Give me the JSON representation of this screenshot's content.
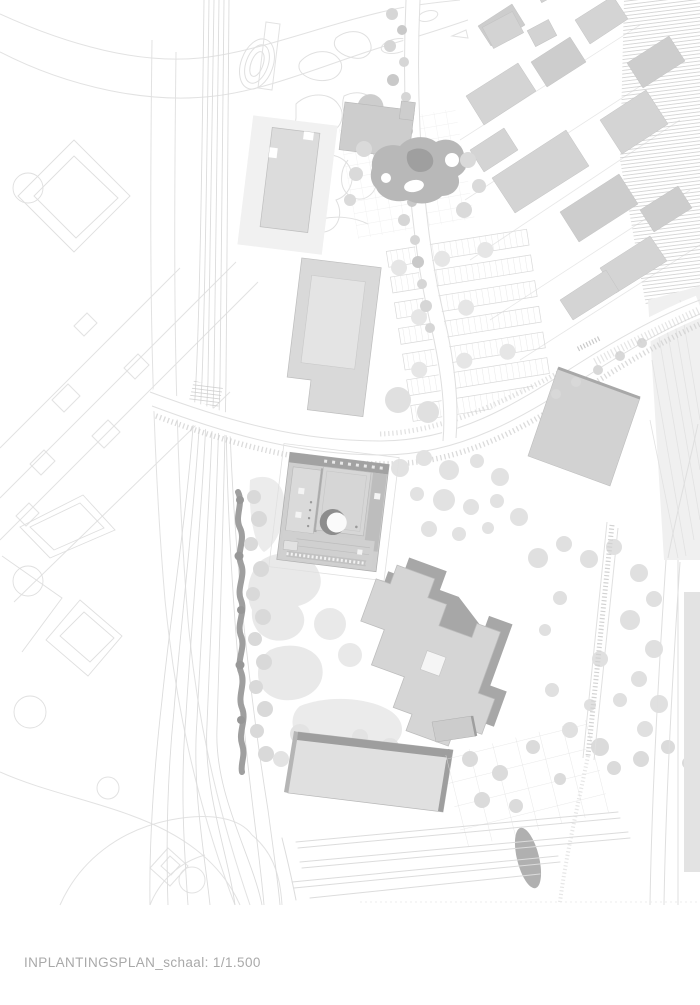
{
  "document": {
    "type": "architectural site plan",
    "title": "INPLANTINGSPLAN",
    "scale_label": "schaal: 1/1.500",
    "caption": "INPLANTINGSPLAN_schaal: 1/1.500"
  },
  "palette": {
    "paper": "#ffffff",
    "faint_line": "#e2e2e2",
    "road_edge": "#dfdfdf",
    "building_light": "#d8d8d8",
    "building_mid": "#cdcdcd",
    "building_dark": "#a9a9a9",
    "shadow_edge": "#9e9e9e",
    "hedge_dark": "#9f9f9f",
    "tree_fill": "#e2e2e2",
    "caption_text": "#a9a9a9"
  }
}
